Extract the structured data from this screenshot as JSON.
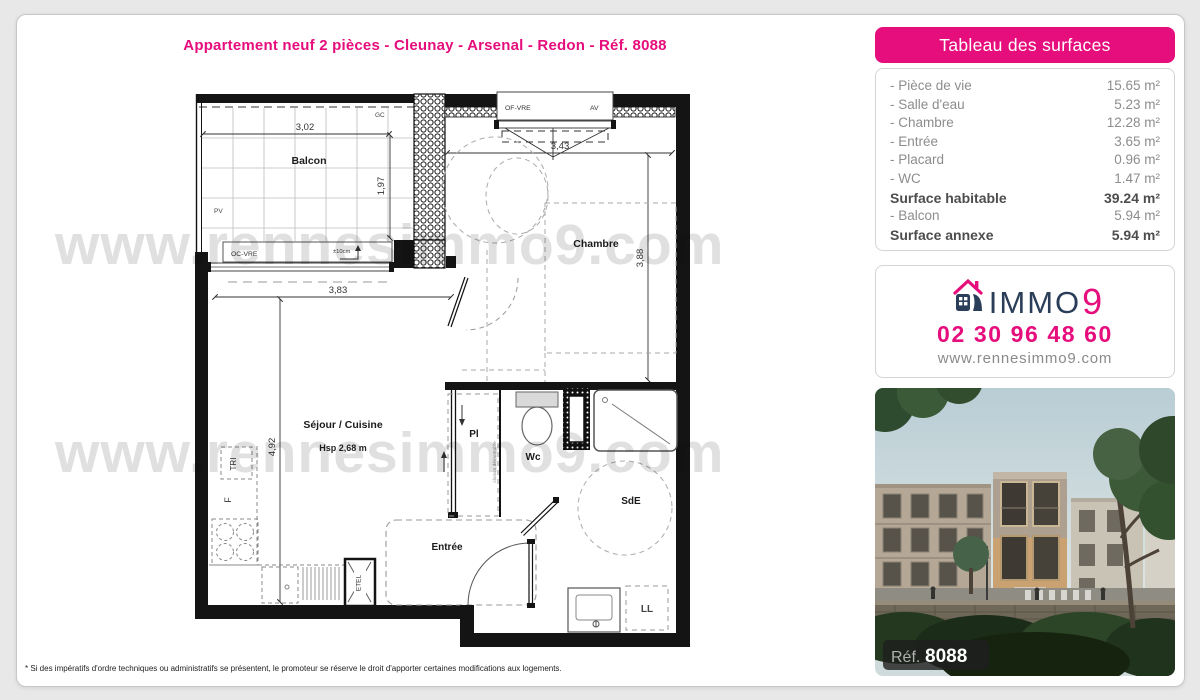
{
  "colors": {
    "pink": "#e60d7c",
    "navy": "#2b3e59",
    "page_bg": "#e8e8e8",
    "wall": "#141414"
  },
  "title": "Appartement neuf 2 pièces - Cleunay - Arsenal - Redon - Réf. 8088",
  "watermark": "www.rennesimmo9.com",
  "footnote": "* Si des impératifs d'ordre techniques ou administratifs se présentent, le promoteur se réserve le droit d'apporter certaines modifications aux logements.",
  "surfaces": {
    "header": "Tableau des surfaces",
    "rows": [
      {
        "label": "- Pièce de vie",
        "value": "15.65 m²",
        "bold": false
      },
      {
        "label": "- Salle d'eau",
        "value": "5.23 m²",
        "bold": false
      },
      {
        "label": "- Chambre",
        "value": "12.28 m²",
        "bold": false
      },
      {
        "label": "- Entrée",
        "value": "3.65 m²",
        "bold": false
      },
      {
        "label": "- Placard",
        "value": "0.96 m²",
        "bold": false
      },
      {
        "label": "- WC",
        "value": "1.47 m²",
        "bold": false
      },
      {
        "label": "Surface habitable",
        "value": "39.24 m²",
        "bold": true
      },
      {
        "label": "- Balcon",
        "value": "5.94 m²",
        "bold": false
      },
      {
        "label": "Surface annexe",
        "value": "5.94 m²",
        "bold": true
      }
    ]
  },
  "agency": {
    "brand_name": "IMMO",
    "brand_digit": "9",
    "phone": "02 30 96 48 60",
    "website": "www.rennesimmo9.com"
  },
  "photo": {
    "ref_label": "Réf.",
    "ref_number": "8088"
  },
  "plan": {
    "balcon": {
      "label": "Balcon",
      "width": "3,02",
      "depth": "1,97",
      "pv": "PV",
      "gc": "GC",
      "window": "OC-VRE",
      "tolerance": "±10cm"
    },
    "chambre": {
      "label": "Chambre",
      "width": "3,43",
      "depth": "3,88",
      "window": "OF-VRE",
      "vent": "AV"
    },
    "sejour": {
      "label": "Séjour / Cuisine",
      "ceiling": "Hsp 2,68 m",
      "width": "3,83",
      "depth": "4,92",
      "tri": "TRI",
      "fridge": "F",
      "etel": "ETEL"
    },
    "entree": {
      "label": "Entrée"
    },
    "placard": {
      "label": "Pl",
      "partition": "cloison démontable"
    },
    "wc": {
      "label": "Wc"
    },
    "sde": {
      "label": "SdE",
      "washer": "LL"
    }
  }
}
